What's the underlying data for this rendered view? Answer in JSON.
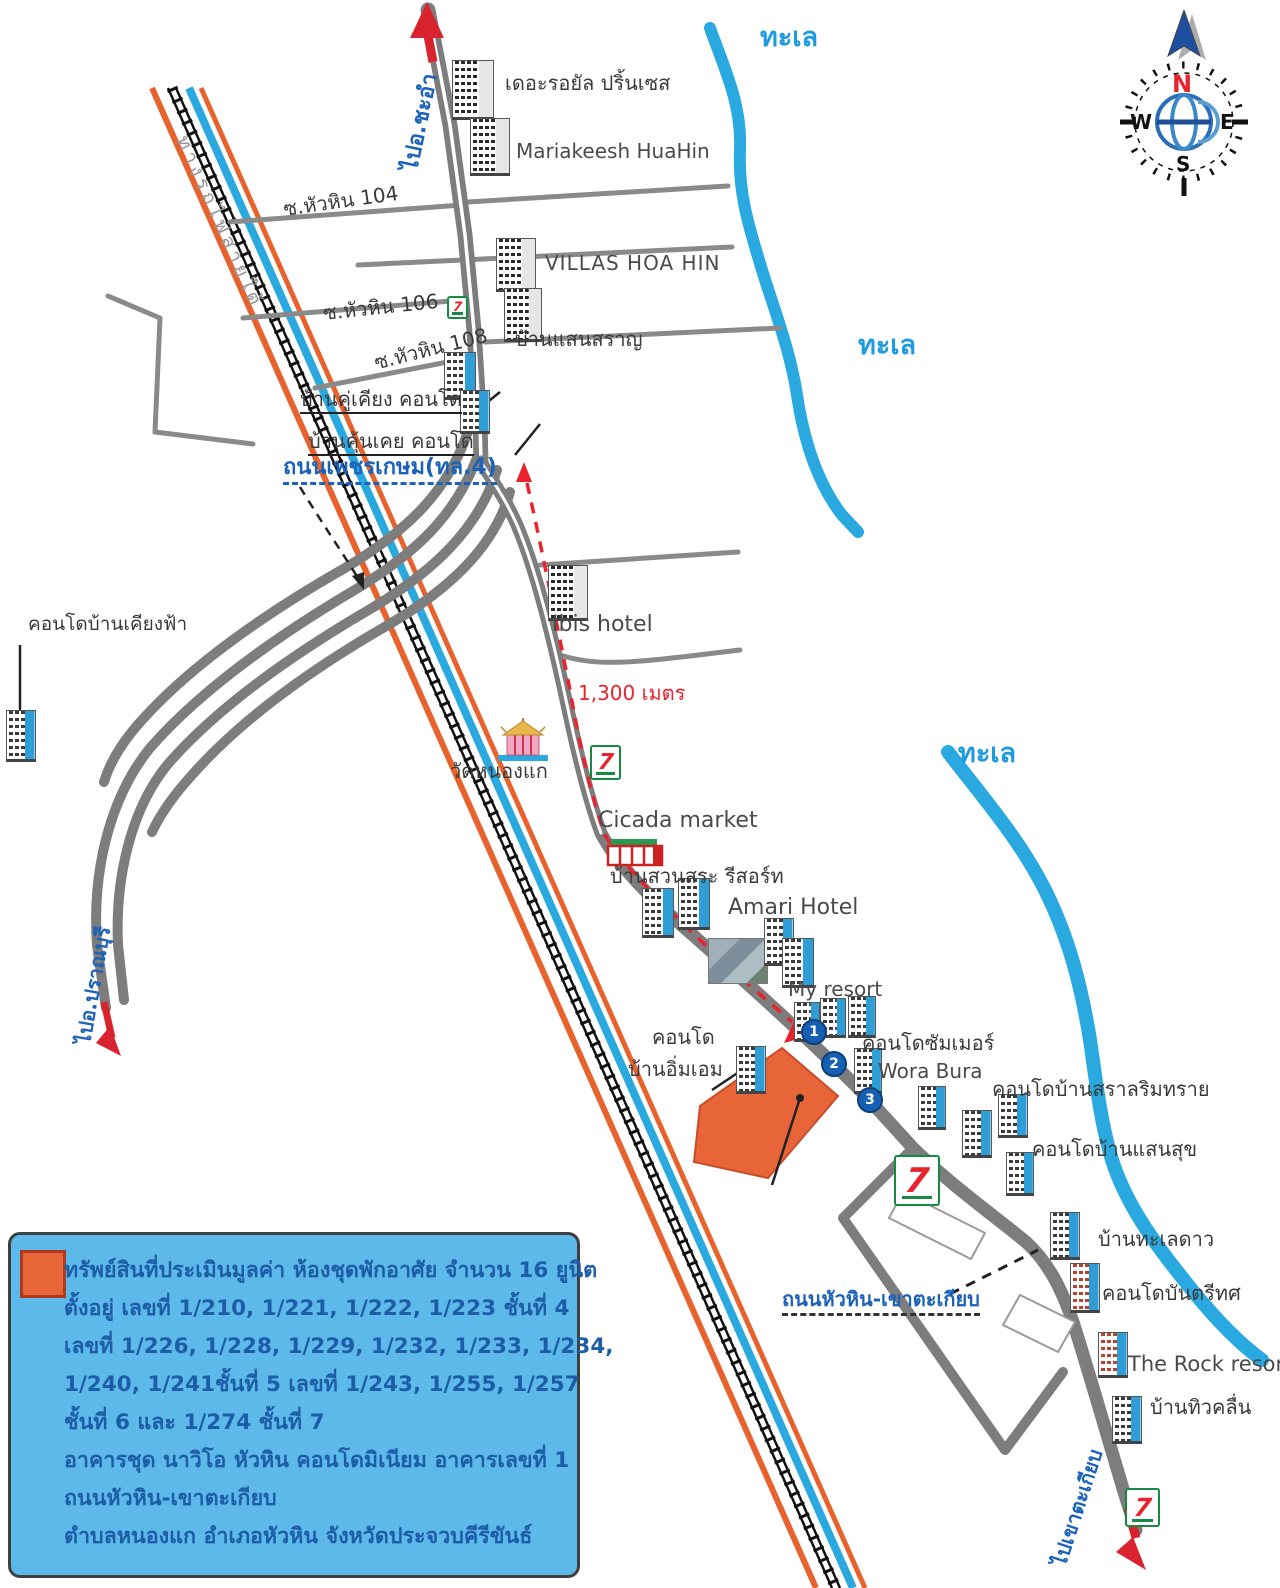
{
  "icons": {
    "seven_glyph": "7"
  },
  "compass": {
    "north": "N",
    "south": "S",
    "east": "E",
    "west": "W"
  },
  "sea_labels": {
    "top": "ทะเล",
    "middle": "ทะเล",
    "lower": "ทะเล"
  },
  "roads": {
    "to_cha_am": "ไปอ.ชะอำ",
    "soi_104": "ซ.หัวหิน 104",
    "soi_106": "ซ.หัวหิน 106",
    "soi_108": "ซ.หัวหิน 108",
    "phetkasem": "ถนนเพชรเกษม(ทล.4)",
    "railway": "ทางรถไฟสายใต้",
    "hua_hin_khao_takiab": "ถนนหัวหิน-เขาตะเกียบ",
    "to_khao_takiab": "ไปเขาตะเกียบ",
    "to_pran_buri": "ไปอ.ปราณบุรี",
    "distance": "1,300 เมตร"
  },
  "places": {
    "royal_princess": "เดอะรอยัล ปริ้นเซส",
    "mariakeesh": "Mariakeesh HuaHin",
    "villas_hoa_hin": "VILLAS HOA HIN",
    "baan_saen_saran": "บ้านแสนสราญ",
    "baan_khu_khiang": "บ้านคู่เคียง คอนโด",
    "baan_khun_khoei": "บ้านคุ้นเคย คอนโด",
    "condo_baan_khiang_fa": "คอนโดบ้านเคียงฟ้า",
    "ibis": "Ibis hotel",
    "wat_nong_kae": "วัดหนองแก",
    "cicada": "Cicada market",
    "baan_suan_sa": "บ้านสวนสระ รีสอร์ท",
    "amari": "Amari Hotel",
    "my_resort": "My resort",
    "condo_line1": "คอนโด",
    "condo_line2": "บ้านอิ่มเอม",
    "condo_summer": "คอนโดซัมเมอร์",
    "wora_bura": "Wora Bura",
    "condo_sara_rim_sai": "คอนโดบ้านสราลริมทราย",
    "condo_baan_saen_suk": "คอนโดบ้านแสนสุข",
    "baan_talay_dao": "บ้านทะเลดาว",
    "condo_bantri_thot": "คอนโดบันตรีทศ",
    "the_rock": "The Rock resort",
    "baan_thiu_khluen": "บ้านทิวคลื่น"
  },
  "markers": {
    "m1": "1",
    "m2": "2",
    "m3": "3"
  },
  "legend": {
    "lines": [
      "ทรัพย์สินที่ประเมินมูลค่า ห้องชุดพักอาศัย จำนวน 16 ยูนิต",
      "ตั้งอยู่ เลขที่ 1/210, 1/221, 1/222, 1/223 ชั้นที่ 4",
      "เลขที่ 1/226, 1/228, 1/229, 1/232, 1/233, 1/234,",
      "1/240, 1/241ชั้นที่ 5 เลขที่ 1/243, 1/255, 1/257",
      "ชั้นที่ 6 และ 1/274 ชั้นที่ 7",
      "อาคารชุด นาวิโอ หัวหิน คอนโดมิเนียม  อาคารเลขที่ 1",
      "ถนนหัวหิน-เขาตะเกียบ",
      "ตำบลหนองแก  อำเภอหัวหิน  จังหวัดประจวบคีรีขันธ์"
    ]
  },
  "colors": {
    "property_orange": "#e8653a",
    "road_gray": "#7d7d7d",
    "water_blue": "#2aa9e0",
    "canal_orange": "#e8622d",
    "legend_bg": "#5db9ea",
    "legend_text": "#1d5ca6",
    "accent_red": "#e8232e",
    "label_blue": "#1b62b8"
  }
}
